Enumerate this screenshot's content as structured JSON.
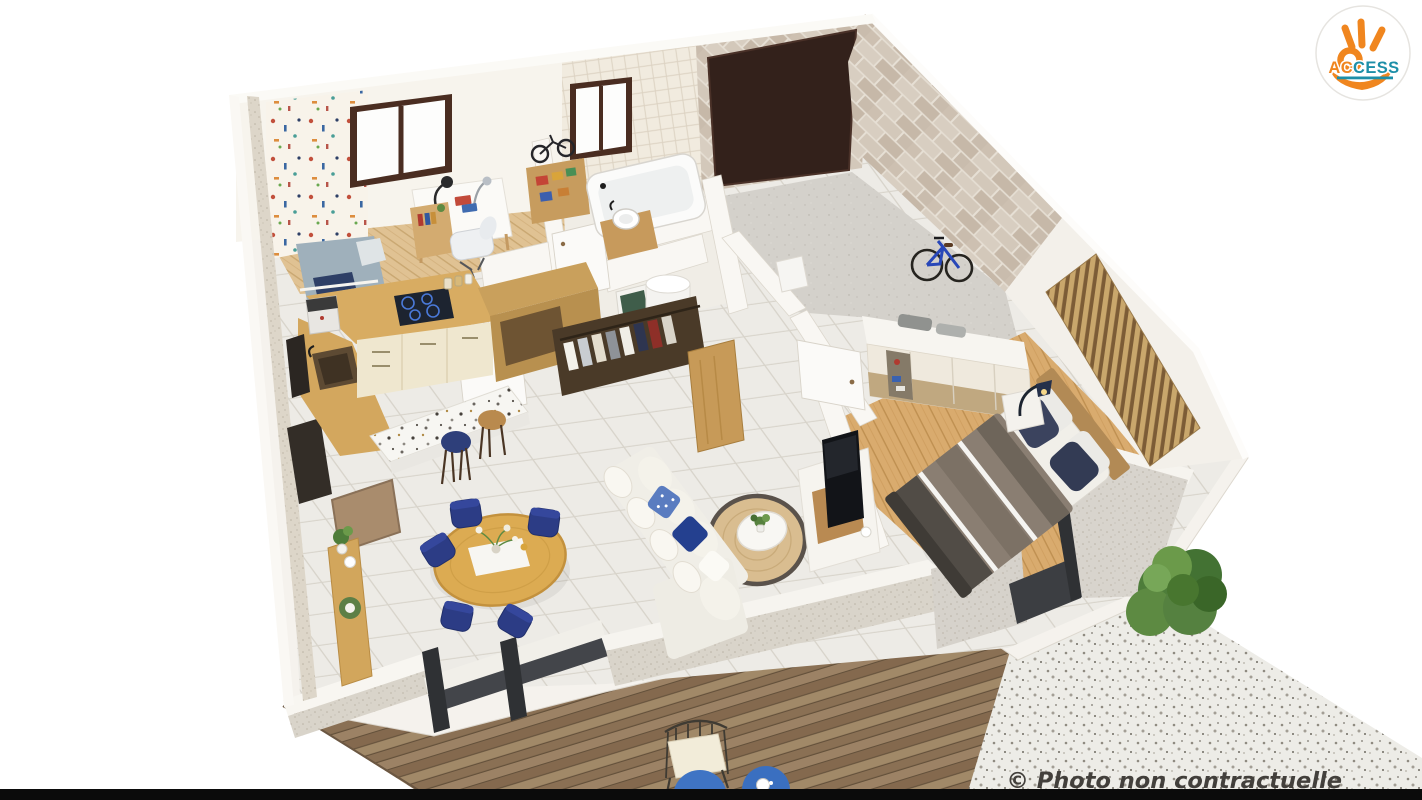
{
  "scene": {
    "description": "Isometric 3D rendered floor plan of a single-storey home: kid bedroom with desk, kitchen, bathroom, WC, dressing with wardrobe, garage with bicycle, master bedroom with slatted headboard wall, open living-dining room, wooden deck and gravel terrace with bush",
    "rooms": [
      "kid-bedroom-office",
      "kitchen",
      "bathroom",
      "wc",
      "dressing",
      "hallway",
      "garage",
      "master-bedroom",
      "living-room",
      "dining-area",
      "deck",
      "gravel-terrace"
    ]
  },
  "logo": {
    "name": "ACCESS",
    "text_orange": "AC",
    "text_teal": "CESS",
    "colors": {
      "orange": "#EF861F",
      "teal": "#1D8FA8",
      "badge": "#FFFFFF"
    }
  },
  "watermark": {
    "text": "© Photo non contractuelle",
    "color": "#35322E"
  },
  "palette": {
    "background": "#FFFFFF",
    "bottom_bar": "#0B0B0B",
    "wall_white": "#F5F2ED",
    "stone_wall": "#D0C5B7",
    "garage_door": "#33211B",
    "tile_floor": "#EDEBE6",
    "wood_floor": "#E0C293",
    "deck_wood": "#93795D",
    "gravel": "#EDECE7",
    "sofa": "#F0EEE7",
    "rug": "#D9BD90",
    "dining_chair_navy": "#2C3C85",
    "bed_duvet_gray": "#8A7E72",
    "accent_blue": "#2E4DA0",
    "kitchen_wood": "#D8AC62",
    "kitchen_cabinet": "#EFE7CF",
    "bush_green": "#4E7D3A"
  }
}
